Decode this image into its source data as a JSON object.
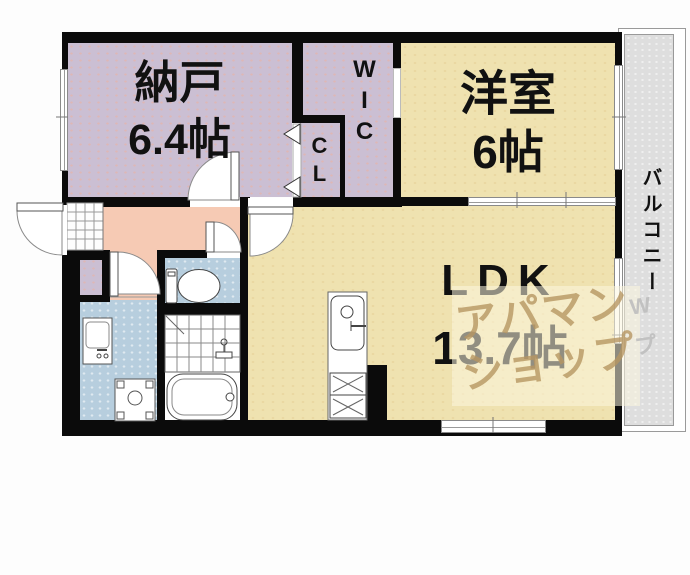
{
  "floorplan": {
    "rooms": {
      "nando": {
        "name": "納戸",
        "size": "6.4帖"
      },
      "wic": {
        "name": "WIC"
      },
      "cl": {
        "name": "CL"
      },
      "yoshitsu": {
        "name": "洋室",
        "size": "6帖"
      },
      "ldk": {
        "name": "LDK",
        "size": "13.7帖"
      },
      "balcony": {
        "name": "バルコニー"
      }
    },
    "watermark": {
      "line1": "アパマン",
      "line2": "ショップ",
      "side_mark": "W",
      "side_mark2": "プ"
    },
    "colors": {
      "wall": "#0b0b0b",
      "storage_floor": "#cbbfd3",
      "living_floor": "#efe2b0",
      "hall_floor": "#f6cab4",
      "wet_area_floor": "#b7cede",
      "balcony_floor": "#dedede",
      "watermark_text": "#b69662"
    }
  }
}
